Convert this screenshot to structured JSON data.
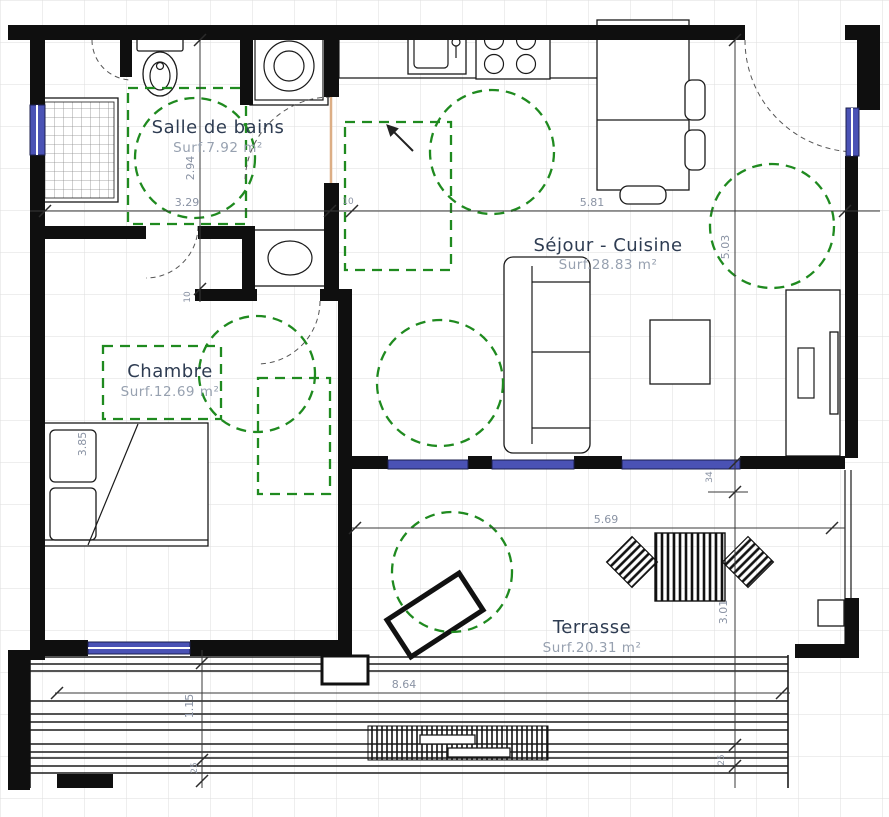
{
  "plan": {
    "type": "apartment-floor-plan",
    "rooms": {
      "bathroom": {
        "name": "Salle de bains",
        "area": "Surf.7.92 m²"
      },
      "living": {
        "name": "Séjour - Cuisine",
        "area": "Surf.28.83 m²"
      },
      "bedroom": {
        "name": "Chambre",
        "area": "Surf.12.69 m²"
      },
      "terrace": {
        "name": "Terrasse",
        "area": "Surf.20.31 m²"
      }
    },
    "dims": {
      "bathroom_width": "3.29",
      "wall_top": "10",
      "living_width": "5.81",
      "entry_height": "2.94",
      "wall_mid": "10",
      "living_height": "5.03",
      "window_pillar": "34",
      "terrace_height": "3.01",
      "terrace_edge_right": "25",
      "bedroom_height": "3.85",
      "terrace_width": "5.69",
      "deck_width": "8.64",
      "deck_side_height": "1.15",
      "terrace_edge_left": "25"
    },
    "colors": {
      "wall": "#0f0f0f",
      "accessibility_green": "#1f8a1f",
      "window_blue": "#4a52b5",
      "dimension_text": "#8a93a4",
      "room_label": "#2e3c52",
      "door_leaf_tan": "#dcae85",
      "grid": "#dedede"
    }
  }
}
